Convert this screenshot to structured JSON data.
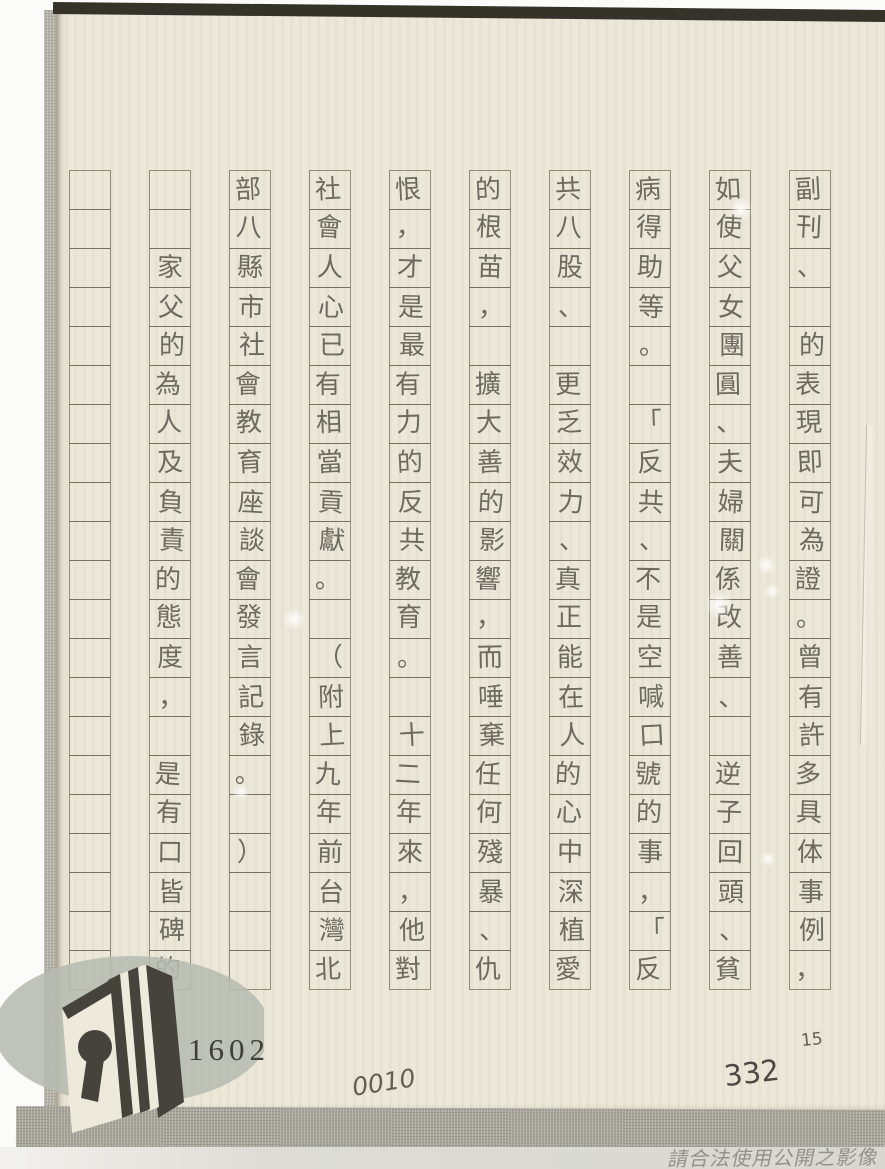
{
  "page": {
    "kind": "scanned handwritten manuscript on vertical grid paper",
    "reading_order": "columns right-to-left, cells top-to-bottom",
    "grid": {
      "columns_count": 10,
      "rows_count": 21,
      "columns": [
        [
          "副",
          "刊",
          "、",
          "",
          "的",
          "表",
          "現",
          "即",
          "可",
          "為",
          "證",
          "。",
          "曾",
          "有",
          "許",
          "多",
          "具",
          "体",
          "事",
          "例",
          "，"
        ],
        [
          "如",
          "使",
          "父",
          "女",
          "團",
          "圓",
          "、",
          "夫",
          "婦",
          "關",
          "係",
          "改",
          "善",
          "、",
          "",
          "逆",
          "子",
          "回",
          "頭",
          "、",
          "貧"
        ],
        [
          "病",
          "得",
          "助",
          "等",
          "。",
          "",
          "「",
          "反",
          "共",
          "、",
          "不",
          "是",
          "空",
          "喊",
          "口",
          "號",
          "的",
          "事",
          "，",
          "「",
          "反"
        ],
        [
          "共",
          "八",
          "股",
          "、",
          "",
          "更",
          "乏",
          "效",
          "力",
          "、",
          "真",
          "正",
          "能",
          "在",
          "人",
          "的",
          "心",
          "中",
          "深",
          "植",
          "愛"
        ],
        [
          "的",
          "根",
          "苗",
          "，",
          "",
          "擴",
          "大",
          "善",
          "的",
          "影",
          "響",
          "，",
          "而",
          "唾",
          "棄",
          "任",
          "何",
          "殘",
          "暴",
          "、",
          "仇"
        ],
        [
          "恨",
          "，",
          "才",
          "是",
          "最",
          "有",
          "力",
          "的",
          "反",
          "共",
          "教",
          "育",
          "。",
          "",
          "十",
          "二",
          "年",
          "來",
          "，",
          "他",
          "對"
        ],
        [
          "社",
          "會",
          "人",
          "心",
          "已",
          "有",
          "相",
          "當",
          "貢",
          "獻",
          "。",
          "",
          "（",
          "附",
          "上",
          "九",
          "年",
          "前",
          "台",
          "灣",
          "北"
        ],
        [
          "部",
          "八",
          "縣",
          "市",
          "社",
          "會",
          "教",
          "育",
          "座",
          "談",
          "會",
          "發",
          "言",
          "記",
          "錄",
          "。",
          "",
          "）",
          "",
          "",
          ""
        ],
        [
          "",
          "",
          "家",
          "父",
          "的",
          "為",
          "人",
          "及",
          "負",
          "責",
          "的",
          "態",
          "度",
          "，",
          "",
          "是",
          "有",
          "口",
          "皆",
          "碑",
          "的"
        ],
        [
          "",
          "",
          "",
          "",
          "",
          "",
          "",
          "",
          "",
          "",
          "",
          "",
          "",
          "",
          "",
          "",
          "",
          "",
          "",
          "",
          ""
        ]
      ]
    },
    "stamps": {
      "printed_number": "1602",
      "handwritten_number": "0010",
      "handwritten_number_small": "15",
      "handwritten_number_corner": "332"
    },
    "watermark": {
      "text": "請合法使用公開之影像"
    },
    "logo": {
      "name": "book-keyhole-logo"
    },
    "colors": {
      "paper": "#ece8d9",
      "grid_line": "#70664f",
      "ink": "#4e4b43",
      "fabric": "#a8a69b",
      "top_edge": "#35322a",
      "logo_ellipse": "#b7bbb1",
      "logo_book": "#45433c",
      "watermark_text": "#8f8e88"
    }
  }
}
